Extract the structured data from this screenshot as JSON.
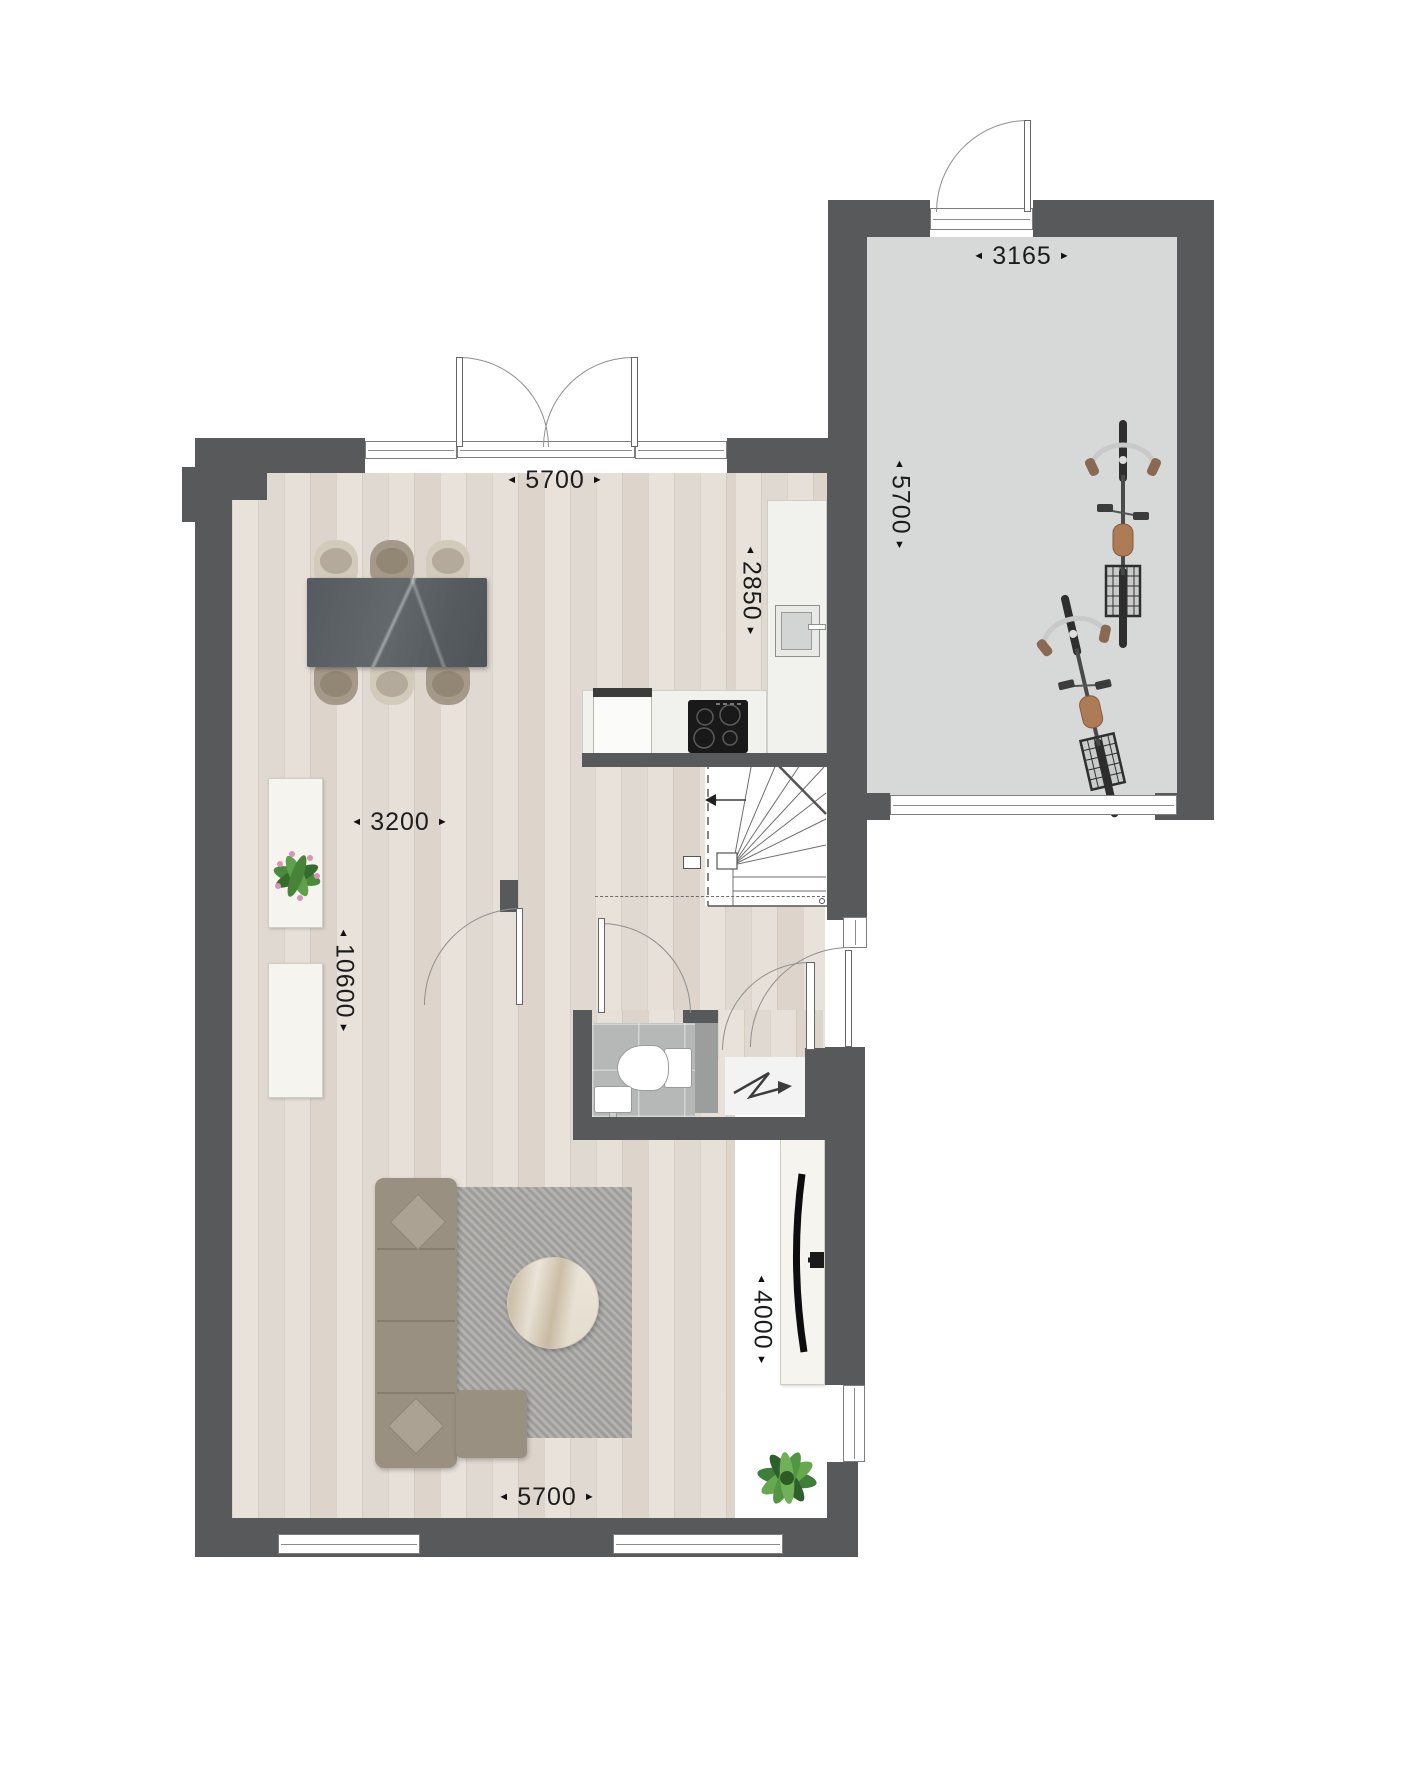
{
  "title": "Ground floor plan",
  "colors": {
    "wall": "#58595b",
    "wood_floor": "#e5dfd8",
    "garage_floor": "#d7d9d8",
    "wc_tile_floor": "#b5b8b7",
    "counter": "#f1f1ee",
    "sofa": "#9a9082",
    "rug": "#a8a7a4",
    "dining_table": "#575d61",
    "label_text": "#1c1c1c"
  },
  "dims": {
    "garage_width": {
      "value": "3165",
      "left_arrow": "◄",
      "right_arrow": "►"
    },
    "garage_depth": {
      "value": "5700",
      "up_arrow": "▲",
      "down_arrow": "▼"
    },
    "living_width_top": {
      "value": "5700",
      "left_arrow": "◄",
      "right_arrow": "►"
    },
    "kitchen_depth": {
      "value": "2850",
      "up_arrow": "▲",
      "down_arrow": "▼"
    },
    "living_width_mid": {
      "value": "3200",
      "left_arrow": "◄",
      "right_arrow": "►"
    },
    "living_depth": {
      "value": "10600",
      "up_arrow": "▲",
      "down_arrow": "▼"
    },
    "sitting_depth": {
      "value": "4000",
      "up_arrow": "▲",
      "down_arrow": "▼"
    },
    "living_width_bottom": {
      "value": "5700",
      "left_arrow": "◄",
      "right_arrow": "►"
    }
  },
  "icons": {
    "stair_direction": "left-arrow",
    "electrical_meter": "zigzag-arrow"
  }
}
